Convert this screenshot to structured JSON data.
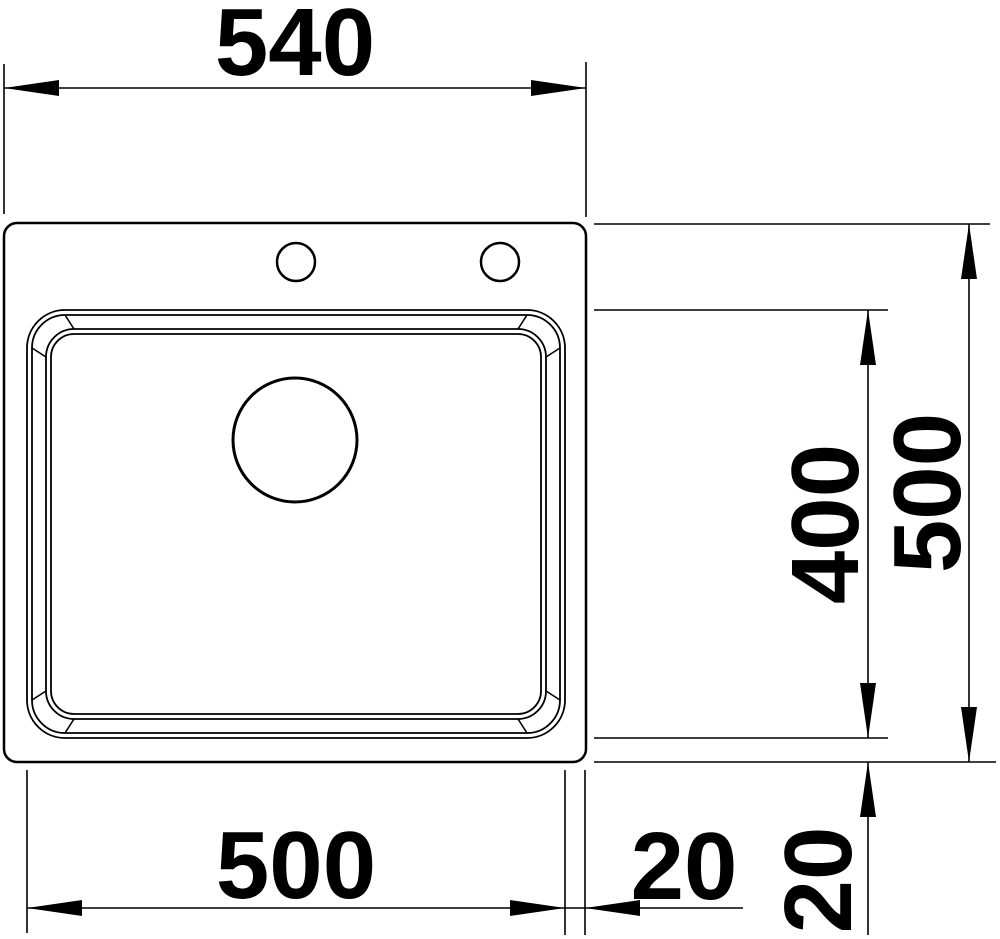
{
  "drawing": {
    "type": "technical-dimension-drawing",
    "subject": "kitchen sink top view with single bowl, drain hole and two tap holes",
    "units": "mm",
    "colors": {
      "line": "#000000",
      "background": "#ffffff"
    },
    "dimensions": {
      "overall_width": "540",
      "overall_depth": "500",
      "bowl_depth": "400",
      "bowl_width": "500",
      "right_edge_gap": "20",
      "bottom_edge_gap": "20"
    }
  }
}
